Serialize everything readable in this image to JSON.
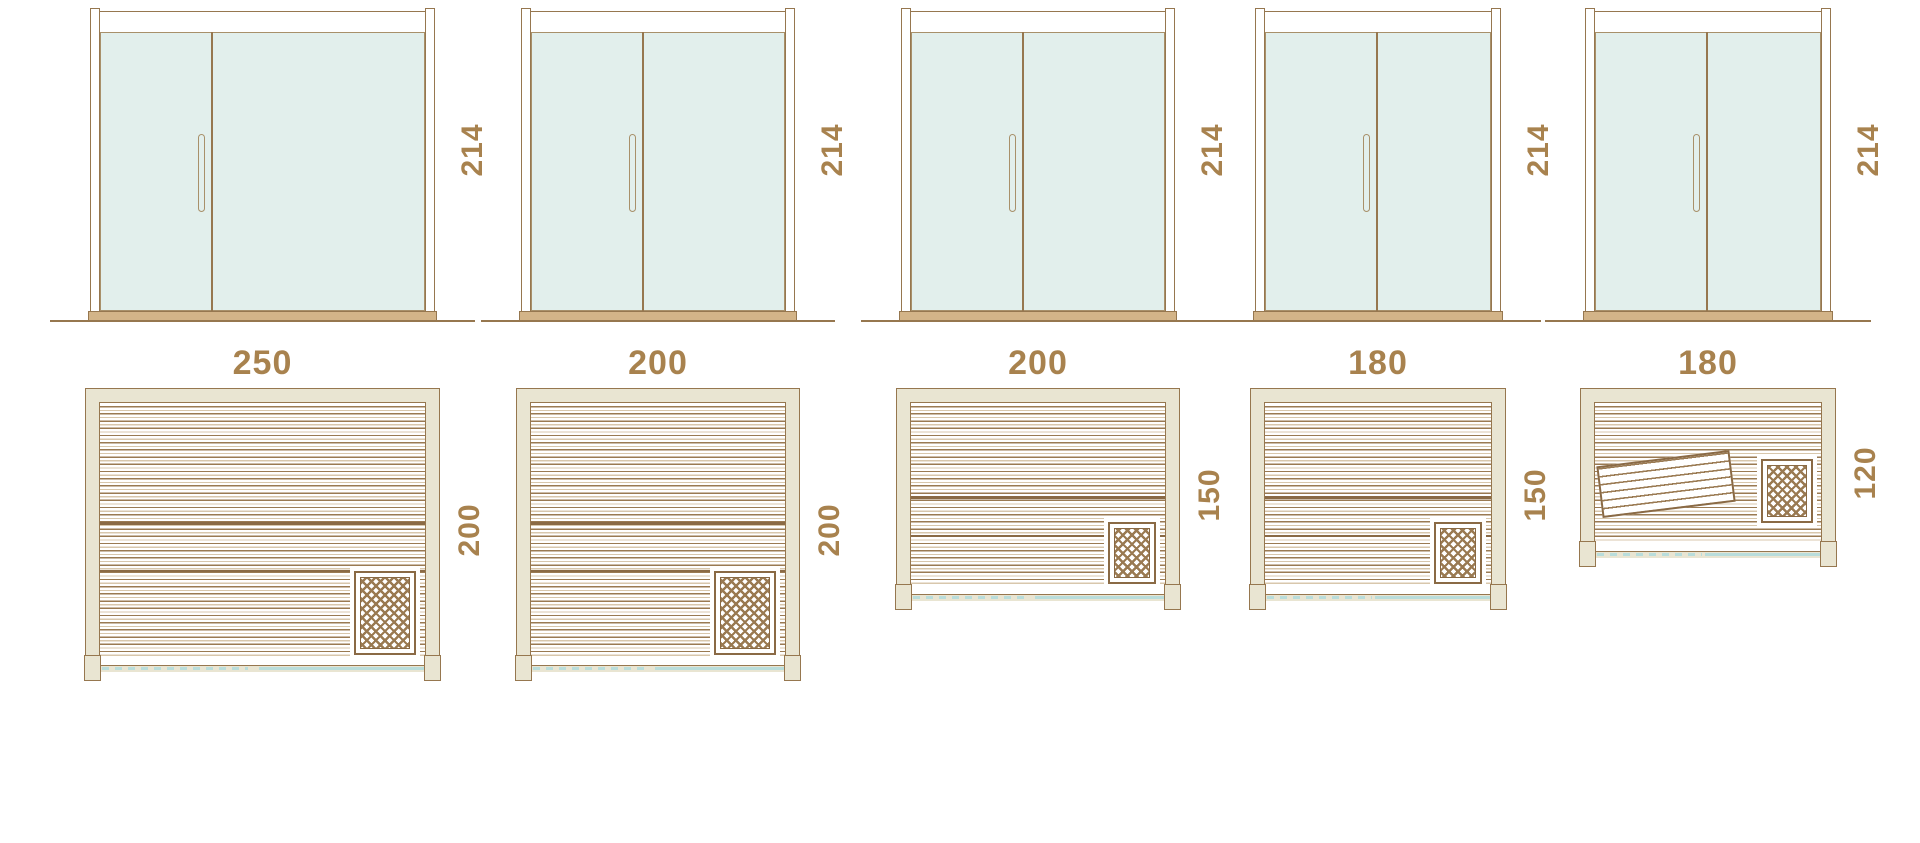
{
  "diagram_type": "sauna size comparison – door elevations, floor plans and seating capacity",
  "colors": {
    "line_brown": "#96774f",
    "dark_brown": "#8a6a45",
    "label_brown": "#a8824e",
    "wall_beige": "#e9e5d2",
    "glass_mint": "#e2efec",
    "door_swing_teal": "#b9dddb",
    "people_tan": "#9d8363",
    "sill_tan": "#d3b488"
  },
  "icons": {
    "heater": "crosshatch-lattice square in plan corner",
    "door_leaf": "small split plank with two dots at end of swing line",
    "person_standing": "outline figure with arms behind head",
    "person_seated": "outline seated figure with hanging legs",
    "person_reclining": "outline lying figure"
  },
  "units": [
    {
      "name": "sauna-250x200",
      "door_height_label": "214",
      "width_label": "250",
      "depth_label": "200",
      "width_cm": 250,
      "depth_cm": 200,
      "capacity_people": 6,
      "people": [
        "standing",
        "standing",
        "seated",
        "seated",
        "seated",
        "reclining"
      ],
      "reclining_side": "right",
      "tilted_bench": false
    },
    {
      "name": "sauna-200x200",
      "door_height_label": "214",
      "width_label": "200",
      "depth_label": "200",
      "width_cm": 200,
      "depth_cm": 200,
      "capacity_people": 5,
      "people": [
        "reclining",
        "seated",
        "seated",
        "seated",
        "standing"
      ],
      "reclining_side": "left",
      "tilted_bench": false
    },
    {
      "name": "sauna-200x150",
      "door_height_label": "214",
      "width_label": "200",
      "depth_label": "150",
      "width_cm": 200,
      "depth_cm": 150,
      "capacity_people": 5,
      "people": [
        "reclining",
        "seated",
        "seated",
        "seated",
        "seated"
      ],
      "reclining_side": "left",
      "tilted_bench": false
    },
    {
      "name": "sauna-180x150",
      "door_height_label": "214",
      "width_label": "180",
      "depth_label": "150",
      "width_cm": 180,
      "depth_cm": 150,
      "capacity_people": 4,
      "people": [
        "reclining",
        "seated",
        "seated",
        "seated"
      ],
      "reclining_side": "left",
      "tilted_bench": false
    },
    {
      "name": "sauna-180x120",
      "door_height_label": "214",
      "width_label": "180",
      "depth_label": "120",
      "width_cm": 180,
      "depth_cm": 120,
      "capacity_people": 3,
      "people": [
        "reclining",
        "seated",
        "seated"
      ],
      "reclining_side": "left",
      "tilted_bench": true
    }
  ]
}
